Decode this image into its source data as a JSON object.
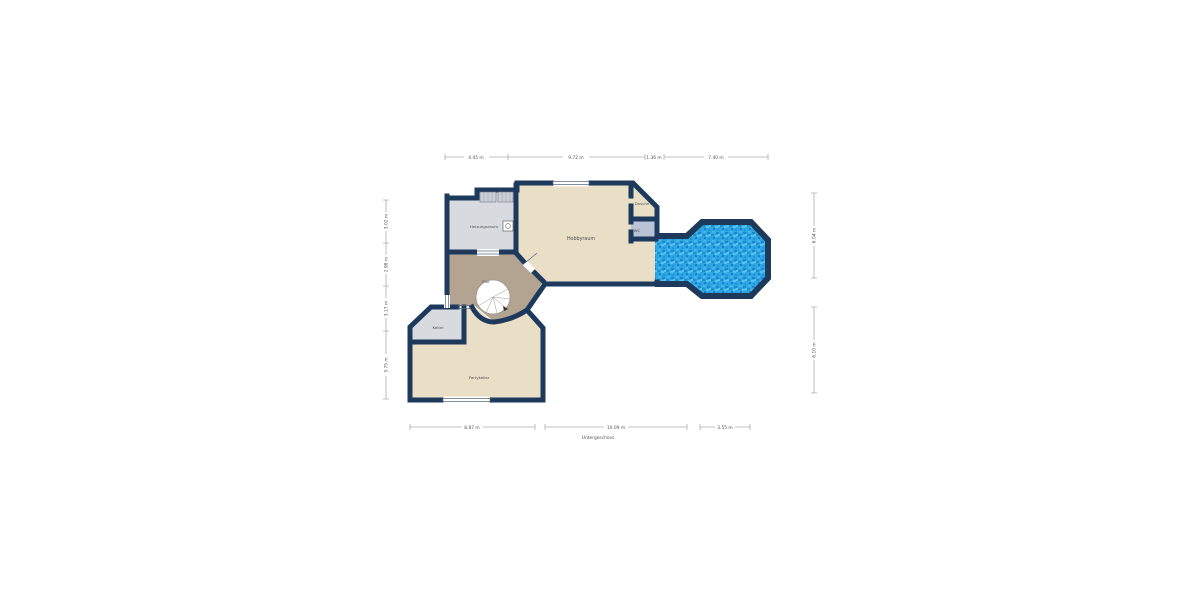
{
  "plan": {
    "caption": "Untergeschoss",
    "rooms": {
      "heizungsraum": "Heizungsraum",
      "hobbyraum": "Hobbyraum",
      "dusche": "Dusche",
      "wc": "WC",
      "flur": "Flur",
      "keller": "Keller",
      "partykeller": "Partykeller"
    },
    "dims": {
      "top": [
        "4.45 m",
        "9.72 m",
        "1.36 m",
        "7.40 m"
      ],
      "left": [
        "3.02 m",
        "2.98 m",
        "3.17 m",
        "3.75 m"
      ],
      "right": [
        "6.04 m",
        "6.10 m"
      ],
      "bottom": [
        "8.87 m",
        "10.09 m",
        "3.55 m"
      ]
    },
    "colors": {
      "wall": "#1d3a5c",
      "floor_beige": "#e9dfc7",
      "floor_gray": "#d7dade",
      "floor_tan": "#b3a391",
      "floor_bluegray": "#b9c3d6",
      "pool_base": "#2da7e4",
      "pool_dark": "#1b7ec9",
      "pool_light": "#5cc3f0",
      "dim_line": "#a8adb4",
      "text": "#555555"
    }
  }
}
